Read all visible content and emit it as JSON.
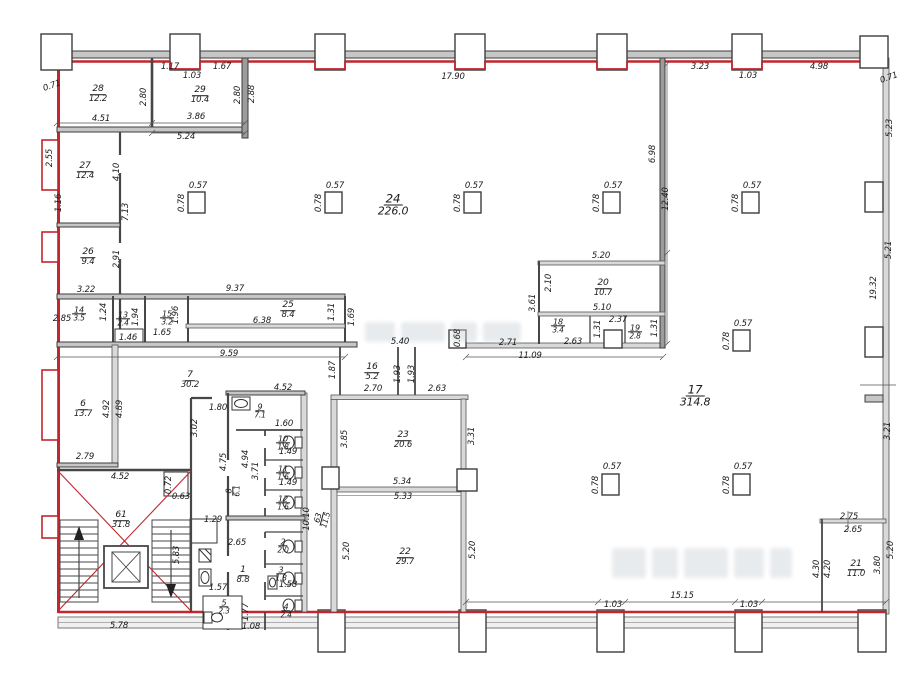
{
  "colors": {
    "outline_red": "#c2262e",
    "wall_gray": "#c6c6c6",
    "line_dark": "#3d3d3d",
    "text": "#1b1b1b",
    "watermark": "#cdd3d8"
  },
  "rooms": [
    {
      "num": "28",
      "area": "12.2",
      "x": 98,
      "y": 94
    },
    {
      "num": "29",
      "area": "10.4",
      "x": 200,
      "y": 95
    },
    {
      "num": "27",
      "area": "12.4",
      "x": 85,
      "y": 171
    },
    {
      "num": "26",
      "area": "9.4",
      "x": 88,
      "y": 257
    },
    {
      "num": "14",
      "area": "3.5",
      "x": 79,
      "y": 314,
      "sz": 7.5
    },
    {
      "num": "13",
      "area": "2.4",
      "x": 123,
      "y": 319,
      "sz": 7.5
    },
    {
      "num": "15",
      "area": "3.2",
      "x": 167,
      "y": 318,
      "sz": 7.5
    },
    {
      "num": "25",
      "area": "8.4",
      "x": 288,
      "y": 310
    },
    {
      "num": "24",
      "area": "226.0",
      "x": 393,
      "y": 205,
      "sz": 11
    },
    {
      "num": "7",
      "area": "30.2",
      "x": 190,
      "y": 380
    },
    {
      "num": "6",
      "area": "13.7",
      "x": 83,
      "y": 409
    },
    {
      "num": "9",
      "area": "7.1",
      "x": 260,
      "y": 411,
      "sz": 7.5
    },
    {
      "num": "10",
      "area": "1.8",
      "x": 283,
      "y": 443,
      "sz": 7.5
    },
    {
      "num": "11",
      "area": "1.6",
      "x": 283,
      "y": 473,
      "sz": 7.5
    },
    {
      "num": "12",
      "area": "1.6",
      "x": 283,
      "y": 503,
      "sz": 7.5
    },
    {
      "num": "8",
      "area": "6.1",
      "x": 233,
      "y": 491,
      "r": -90,
      "sz": 7.5
    },
    {
      "num": "16",
      "area": "5.2",
      "x": 372,
      "y": 372
    },
    {
      "num": "20",
      "area": "10.7",
      "x": 603,
      "y": 288
    },
    {
      "num": "18",
      "area": "3.4",
      "x": 558,
      "y": 326,
      "sz": 7.5
    },
    {
      "num": "19",
      "area": "2.8",
      "x": 635,
      "y": 332,
      "sz": 7.5
    },
    {
      "num": "23",
      "area": "20.6",
      "x": 403,
      "y": 440
    },
    {
      "num": "22",
      "area": "29.7",
      "x": 405,
      "y": 557
    },
    {
      "num": "17",
      "area": "314.8",
      "x": 695,
      "y": 396,
      "sz": 11
    },
    {
      "num": "21",
      "area": "11.0",
      "x": 856,
      "y": 569
    },
    {
      "num": "61",
      "area": "31.8",
      "x": 121,
      "y": 520
    },
    {
      "num": "63",
      "area": "11.5",
      "x": 322,
      "y": 519,
      "r": -75,
      "sz": 7.5
    },
    {
      "num": "1",
      "area": "8.8",
      "x": 243,
      "y": 575
    },
    {
      "num": "2",
      "area": "2.0",
      "x": 283,
      "y": 546,
      "sz": 7.5
    },
    {
      "num": "3",
      "area": "1.8",
      "x": 281,
      "y": 574,
      "sz": 7.5
    },
    {
      "num": "4",
      "area": "2.4",
      "x": 286,
      "y": 611,
      "sz": 7.5
    },
    {
      "num": "5",
      "area": "2.3",
      "x": 224,
      "y": 607,
      "sz": 7.5
    }
  ],
  "dims": [
    {
      "t": "0.71",
      "x": 52,
      "y": 86,
      "r": -20
    },
    {
      "t": "1.17",
      "x": 170,
      "y": 67
    },
    {
      "t": "1.03",
      "x": 192,
      "y": 76
    },
    {
      "t": "1.67",
      "x": 222,
      "y": 67
    },
    {
      "t": "17.90",
      "x": 453,
      "y": 77
    },
    {
      "t": "3.23",
      "x": 700,
      "y": 67
    },
    {
      "t": "1.03",
      "x": 748,
      "y": 76
    },
    {
      "t": "4.98",
      "x": 819,
      "y": 67
    },
    {
      "t": "0.71",
      "x": 889,
      "y": 78,
      "r": -20
    },
    {
      "t": "4.51",
      "x": 101,
      "y": 119
    },
    {
      "t": "3.86",
      "x": 196,
      "y": 117
    },
    {
      "t": "5.24",
      "x": 186,
      "y": 137
    },
    {
      "t": "2.80",
      "x": 144,
      "y": 97,
      "r": -90
    },
    {
      "t": "2.80",
      "x": 238,
      "y": 95,
      "r": -90
    },
    {
      "t": "2.88",
      "x": 252,
      "y": 94,
      "r": -90
    },
    {
      "t": "2.55",
      "x": 50,
      "y": 158,
      "r": -90
    },
    {
      "t": "1.16",
      "x": 59,
      "y": 203,
      "r": -90
    },
    {
      "t": "4.10",
      "x": 117,
      "y": 172,
      "r": -90
    },
    {
      "t": "7.13",
      "x": 126,
      "y": 212,
      "r": -90
    },
    {
      "t": "2.91",
      "x": 117,
      "y": 259,
      "r": -90
    },
    {
      "t": "3.22",
      "x": 86,
      "y": 290
    },
    {
      "t": "2.85",
      "x": 62,
      "y": 319
    },
    {
      "t": "1.24",
      "x": 104,
      "y": 312,
      "r": -90
    },
    {
      "t": "1.94",
      "x": 136,
      "y": 317,
      "r": -90
    },
    {
      "t": "1.96",
      "x": 176,
      "y": 315,
      "r": -90
    },
    {
      "t": "1.65",
      "x": 162,
      "y": 333
    },
    {
      "t": "1.46",
      "x": 128,
      "y": 338
    },
    {
      "t": "9.37",
      "x": 235,
      "y": 289
    },
    {
      "t": "6.38",
      "x": 262,
      "y": 321
    },
    {
      "t": "1.31",
      "x": 332,
      "y": 312,
      "r": -90
    },
    {
      "t": "1.69",
      "x": 352,
      "y": 317,
      "r": -90
    },
    {
      "t": "9.59",
      "x": 229,
      "y": 354
    },
    {
      "t": "6.98",
      "x": 653,
      "y": 154,
      "r": -90
    },
    {
      "t": "12.40",
      "x": 666,
      "y": 199,
      "r": -90
    },
    {
      "t": "5.23",
      "x": 890,
      "y": 128,
      "r": -90
    },
    {
      "t": "5.21",
      "x": 889,
      "y": 250,
      "r": -90
    },
    {
      "t": "19.32",
      "x": 874,
      "y": 288,
      "r": -90
    },
    {
      "t": "3.21",
      "x": 888,
      "y": 431,
      "r": -90
    },
    {
      "t": "5.20",
      "x": 601,
      "y": 256
    },
    {
      "t": "2.10",
      "x": 549,
      "y": 283,
      "r": -90
    },
    {
      "t": "3.61",
      "x": 533,
      "y": 303,
      "r": -90
    },
    {
      "t": "5.10",
      "x": 602,
      "y": 308
    },
    {
      "t": "2.63",
      "x": 573,
      "y": 342
    },
    {
      "t": "1.31",
      "x": 598,
      "y": 329,
      "r": -90
    },
    {
      "t": "2.37",
      "x": 618,
      "y": 320
    },
    {
      "t": "1.31",
      "x": 655,
      "y": 328,
      "r": -90
    },
    {
      "t": "11.09",
      "x": 530,
      "y": 356
    },
    {
      "t": "2.71",
      "x": 508,
      "y": 343
    },
    {
      "t": "0.68",
      "x": 458,
      "y": 338,
      "r": -90
    },
    {
      "t": "5.40",
      "x": 400,
      "y": 342
    },
    {
      "t": "1.87",
      "x": 333,
      "y": 370,
      "r": -90
    },
    {
      "t": "1.93",
      "x": 398,
      "y": 374,
      "r": -90
    },
    {
      "t": "1.93",
      "x": 412,
      "y": 374,
      "r": -90
    },
    {
      "t": "2.70",
      "x": 373,
      "y": 389
    },
    {
      "t": "2.63",
      "x": 437,
      "y": 389
    },
    {
      "t": "3.85",
      "x": 345,
      "y": 439,
      "r": -90
    },
    {
      "t": "3.31",
      "x": 472,
      "y": 436,
      "r": -90
    },
    {
      "t": "5.34",
      "x": 402,
      "y": 482
    },
    {
      "t": "5.33",
      "x": 403,
      "y": 497
    },
    {
      "t": "5.20",
      "x": 347,
      "y": 551,
      "r": -90
    },
    {
      "t": "5.20",
      "x": 473,
      "y": 550,
      "r": -90
    },
    {
      "t": "10.10",
      "x": 307,
      "y": 519,
      "r": -90
    },
    {
      "t": "4.52",
      "x": 283,
      "y": 388
    },
    {
      "t": "1.60",
      "x": 284,
      "y": 424
    },
    {
      "t": "4.94",
      "x": 246,
      "y": 459,
      "r": -90
    },
    {
      "t": "3.71",
      "x": 256,
      "y": 471,
      "r": -90
    },
    {
      "t": "4.75",
      "x": 224,
      "y": 462,
      "r": -90
    },
    {
      "t": "1.49",
      "x": 288,
      "y": 452
    },
    {
      "t": "1.49",
      "x": 288,
      "y": 483
    },
    {
      "t": "1.80",
      "x": 218,
      "y": 408
    },
    {
      "t": "3.02",
      "x": 195,
      "y": 428,
      "r": -90
    },
    {
      "t": "4.92",
      "x": 107,
      "y": 409,
      "r": -90
    },
    {
      "t": "4.89",
      "x": 120,
      "y": 409,
      "r": -90
    },
    {
      "t": "2.79",
      "x": 85,
      "y": 457
    },
    {
      "t": "4.52",
      "x": 120,
      "y": 477
    },
    {
      "t": "0.72",
      "x": 169,
      "y": 485,
      "r": -90
    },
    {
      "t": "0.63",
      "x": 181,
      "y": 497
    },
    {
      "t": "1.29",
      "x": 213,
      "y": 520
    },
    {
      "t": "2.65",
      "x": 237,
      "y": 543
    },
    {
      "t": "1.57",
      "x": 218,
      "y": 588
    },
    {
      "t": "1.77",
      "x": 246,
      "y": 612,
      "r": -90
    },
    {
      "t": "1.08",
      "x": 251,
      "y": 627
    },
    {
      "t": "1.58",
      "x": 288,
      "y": 585
    },
    {
      "t": "5.78",
      "x": 119,
      "y": 626
    },
    {
      "t": "5.83",
      "x": 177,
      "y": 555,
      "r": -90
    },
    {
      "t": "2.75",
      "x": 849,
      "y": 517
    },
    {
      "t": "2.65",
      "x": 853,
      "y": 530
    },
    {
      "t": "4.30",
      "x": 817,
      "y": 569,
      "r": -90
    },
    {
      "t": "4.20",
      "x": 828,
      "y": 569,
      "r": -90
    },
    {
      "t": "3.80",
      "x": 878,
      "y": 565,
      "r": -90
    },
    {
      "t": "5.20",
      "x": 891,
      "y": 550,
      "r": -90
    },
    {
      "t": "15.15",
      "x": 682,
      "y": 596
    },
    {
      "t": "1.03",
      "x": 613,
      "y": 605
    },
    {
      "t": "1.03",
      "x": 749,
      "y": 605
    },
    {
      "t": "0.57",
      "x": 198,
      "y": 186
    },
    {
      "t": "0.78",
      "x": 182,
      "y": 203,
      "r": -90
    },
    {
      "t": "0.57",
      "x": 335,
      "y": 186
    },
    {
      "t": "0.78",
      "x": 319,
      "y": 203,
      "r": -90
    },
    {
      "t": "0.57",
      "x": 474,
      "y": 186
    },
    {
      "t": "0.78",
      "x": 458,
      "y": 203,
      "r": -90
    },
    {
      "t": "0.57",
      "x": 613,
      "y": 186
    },
    {
      "t": "0.78",
      "x": 597,
      "y": 203,
      "r": -90
    },
    {
      "t": "0.57",
      "x": 752,
      "y": 186
    },
    {
      "t": "0.78",
      "x": 736,
      "y": 203,
      "r": -90
    },
    {
      "t": "0.57",
      "x": 743,
      "y": 324
    },
    {
      "t": "0.78",
      "x": 727,
      "y": 341,
      "r": -90
    },
    {
      "t": "0.57",
      "x": 612,
      "y": 467
    },
    {
      "t": "0.78",
      "x": 596,
      "y": 485,
      "r": -90
    },
    {
      "t": "0.57",
      "x": 743,
      "y": 467
    },
    {
      "t": "0.78",
      "x": 727,
      "y": 485,
      "r": -90
    }
  ]
}
